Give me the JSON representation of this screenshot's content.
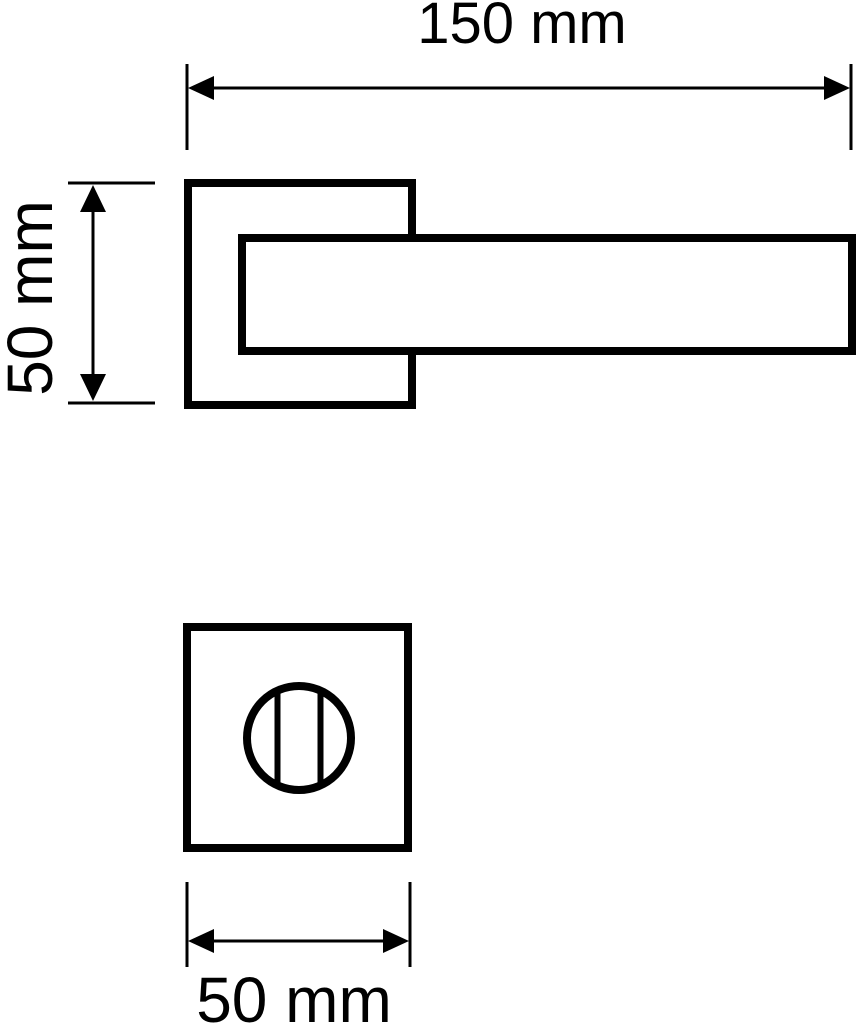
{
  "drawing": {
    "type": "technical-dimension-drawing",
    "subject": "door lever handle on square rosette with WC thumbturn escutcheon",
    "background_color": "#ffffff",
    "line_color": "#000000",
    "labels": {
      "top_dimension": "150 mm",
      "left_dimension": "50 mm",
      "bottom_dimension": "50 mm"
    }
  }
}
